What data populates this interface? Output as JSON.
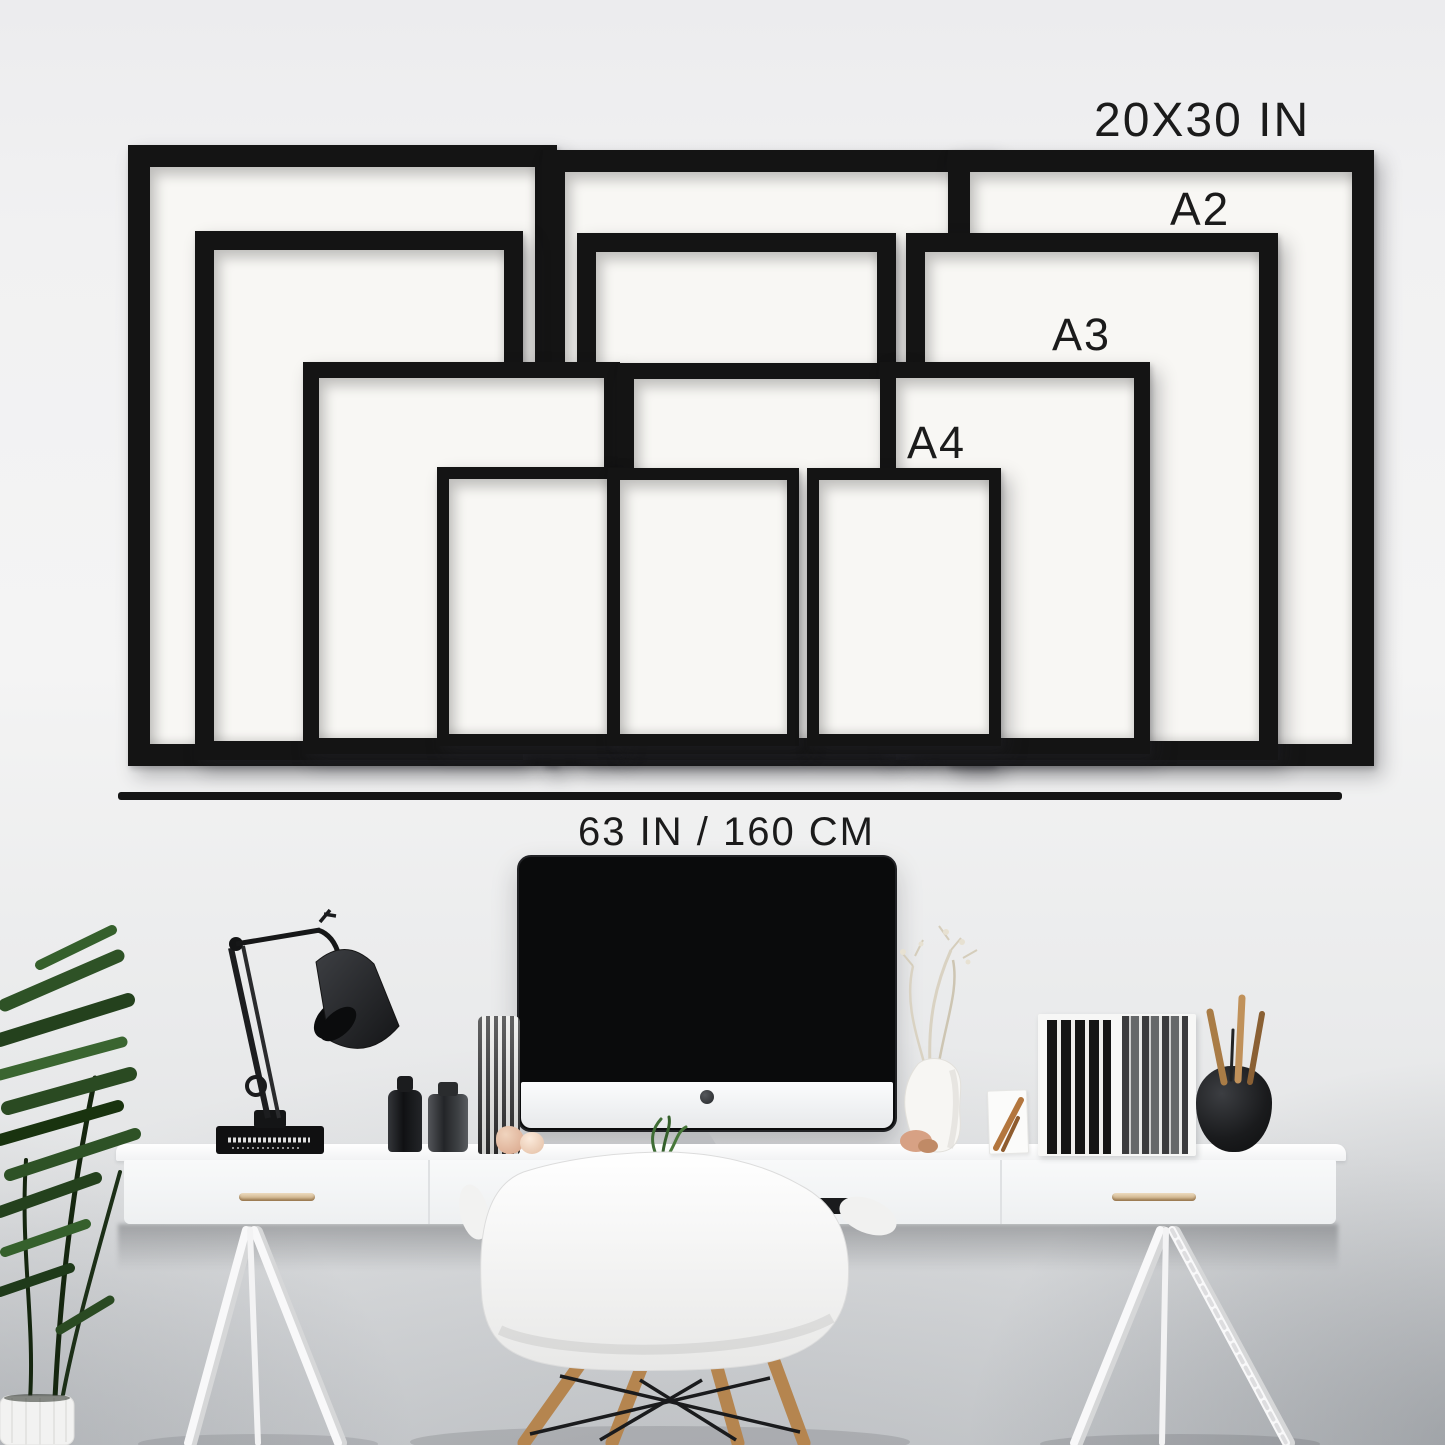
{
  "size_guide": {
    "frame_size_labels": {
      "largest": "20X30 IN",
      "a2": "A2",
      "a3": "A3",
      "a4": "A4"
    },
    "width_measurement_label": "63 IN / 160 CM",
    "sizes_shown": [
      "20X30 IN",
      "A2",
      "A3",
      "A4"
    ],
    "frames_per_size": 3,
    "colors": {
      "frame": "#141414",
      "paper": "#f8f7f4",
      "label_text": "#1b1b1b",
      "measure_line": "#151515",
      "wall": "#f1f1f2"
    }
  },
  "scene": {
    "desk_color": "#f8f9fa",
    "wood_accent": "#b5854f",
    "objects": [
      "potted-plant",
      "desk-lamp",
      "stacked-book",
      "perfume-bottles",
      "striped-card-holder",
      "clay-figurines",
      "imac-computer",
      "shell-chair",
      "dried-branch-vase",
      "wood-figurine-card",
      "magazine-rack-with-books",
      "round-pot-with-brushes",
      "trestle-desk"
    ]
  }
}
